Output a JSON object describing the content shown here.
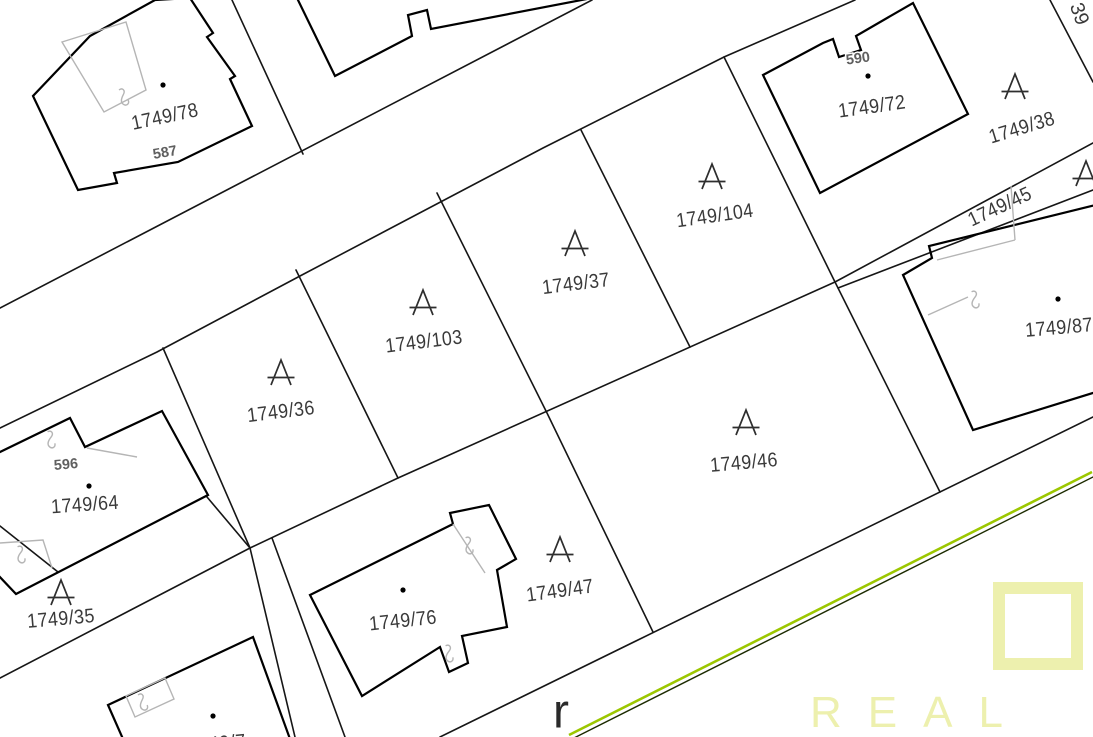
{
  "map": {
    "title": "cadastral-parcel-map",
    "watermark": {
      "text": "REAL",
      "color": "#edf0ae"
    },
    "colors": {
      "background": "#ffffff",
      "parcel_line": "#161616",
      "building_line": "#000000",
      "inner_line": "#b5b5b5",
      "label": "#3a3a3a",
      "building_label": "#5f5f5f",
      "symbol": "#2e2e2e",
      "green_edge": "#9cc700",
      "green_edge_dark": "#1c2b00",
      "watermark": "#edf0ae",
      "street_label": "#2a2a2a"
    },
    "labels": [
      {
        "text": "1749/78",
        "x": 165,
        "y": 117,
        "rot": -12,
        "t": "parcel"
      },
      {
        "text": "587",
        "x": 165,
        "y": 153,
        "rot": -10,
        "t": "bnum"
      },
      {
        "text": "1749/72",
        "x": 872,
        "y": 107,
        "rot": -8,
        "t": "parcel"
      },
      {
        "text": "590",
        "x": 858,
        "y": 59,
        "rot": -8,
        "t": "bnum"
      },
      {
        "text": "39",
        "x": 1079,
        "y": 14,
        "rot": 70,
        "t": "corner"
      },
      {
        "text": "1749/38",
        "x": 1022,
        "y": 128,
        "rot": -17,
        "t": "parcel",
        "sym": [
          1015,
          87
        ]
      },
      {
        "text": "1749/45",
        "x": 1000,
        "y": 207,
        "rot": -25,
        "t": "parcel"
      },
      {
        "text": "",
        "x": 0,
        "y": 0,
        "rot": 0,
        "t": "parcel",
        "sym": [
          1086,
          174
        ]
      },
      {
        "text": "1749/104",
        "x": 715,
        "y": 216,
        "rot": -8,
        "t": "parcel",
        "sym": [
          712,
          177
        ]
      },
      {
        "text": "1749/37",
        "x": 576,
        "y": 284,
        "rot": -7,
        "t": "parcel",
        "sym": [
          575,
          244
        ]
      },
      {
        "text": "1749/103",
        "x": 424,
        "y": 342,
        "rot": -7,
        "t": "parcel",
        "sym": [
          423,
          303
        ]
      },
      {
        "text": "1749/36",
        "x": 281,
        "y": 412,
        "rot": -7,
        "t": "parcel",
        "sym": [
          281,
          373
        ]
      },
      {
        "text": "1749/64",
        "x": 85,
        "y": 505,
        "rot": -4,
        "t": "parcel"
      },
      {
        "text": "596",
        "x": 66,
        "y": 465,
        "rot": -5,
        "t": "bnum"
      },
      {
        "text": "1749/35",
        "x": 61,
        "y": 619,
        "rot": -5,
        "t": "parcel",
        "sym": [
          61,
          593
        ]
      },
      {
        "text": "1749/76",
        "x": 403,
        "y": 621,
        "rot": -6,
        "t": "parcel"
      },
      {
        "text": "1749/47",
        "x": 560,
        "y": 591,
        "rot": -8,
        "t": "parcel",
        "sym": [
          560,
          550
        ]
      },
      {
        "text": "1749/46",
        "x": 744,
        "y": 463,
        "rot": -5,
        "t": "parcel",
        "sym": [
          746,
          423
        ]
      },
      {
        "text": "1749/87",
        "x": 1059,
        "y": 328,
        "rot": -5,
        "t": "parcel"
      },
      {
        "text": "1749/7",
        "x": 217,
        "y": 744,
        "rot": -5,
        "t": "parcel"
      },
      {
        "text": "r",
        "x": 561,
        "y": 712,
        "rot": 0,
        "t": "street"
      }
    ],
    "building_dots": [
      [
        163,
        85
      ],
      [
        868,
        76
      ],
      [
        1058,
        299
      ],
      [
        89,
        486
      ],
      [
        403,
        590
      ],
      [
        213,
        716
      ]
    ],
    "squiggles": [
      [
        121,
        99,
        -25
      ],
      [
        48,
        441,
        -15
      ],
      [
        18,
        556,
        -15
      ],
      [
        466,
        547,
        -15
      ],
      [
        446,
        655,
        -15
      ],
      [
        140,
        704,
        -25
      ],
      [
        972,
        301,
        -15
      ]
    ]
  }
}
